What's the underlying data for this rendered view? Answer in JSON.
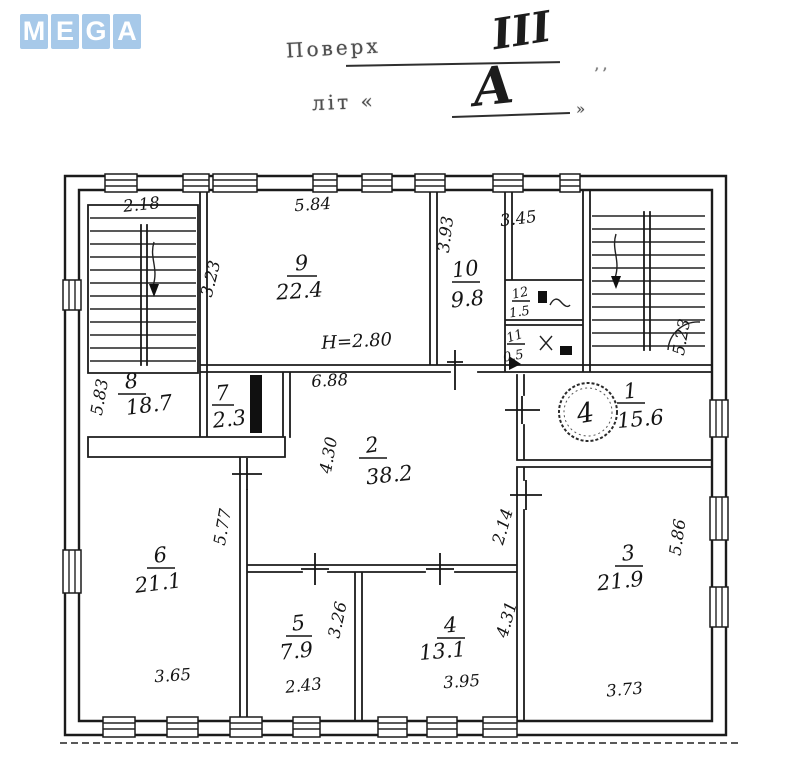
{
  "logo": {
    "letters": [
      "M",
      "E",
      "G",
      "A"
    ],
    "color": "#a7c9e9"
  },
  "title": {
    "floor_label": "Поверх",
    "floor_value": "III",
    "letter_label": "літ «",
    "letter_value": "А",
    "letter_close": "»",
    "stray_mark": "’’"
  },
  "plan": {
    "height_note": "Н=2.80",
    "stamp": "4",
    "rooms": [
      {
        "num": "9",
        "area": "22.4"
      },
      {
        "num": "10",
        "area": "9.8"
      },
      {
        "num": "12",
        "area": "1.5"
      },
      {
        "num": "11",
        "area": "0.5"
      },
      {
        "num": "8",
        "area": "18.7"
      },
      {
        "num": "7",
        "area": "2.3"
      },
      {
        "num": "1",
        "area": "15.6"
      },
      {
        "num": "2",
        "area": "38.2"
      },
      {
        "num": "6",
        "area": "21.1"
      },
      {
        "num": "5",
        "area": "7.9"
      },
      {
        "num": "4",
        "area": "13.1"
      },
      {
        "num": "3",
        "area": "21.9"
      }
    ],
    "dims": {
      "stair_left": "2.18",
      "room9_top": "5.84",
      "room9_side": "3.23",
      "room10_top": "3.45",
      "room10_side": "3.93",
      "stair_right_side": "5.23",
      "room8_side": "5.83",
      "hall_top": "6.88",
      "hall_side": "4.30",
      "room6_side": "5.77",
      "room6_bottom": "3.65",
      "room5_bottom": "2.43",
      "room5_side": "3.26",
      "room4_bottom": "3.95",
      "room4_side": "4.31",
      "room3_side_upper": "2.14",
      "room3_right": "5.86",
      "room3_bottom": "3.73"
    }
  }
}
